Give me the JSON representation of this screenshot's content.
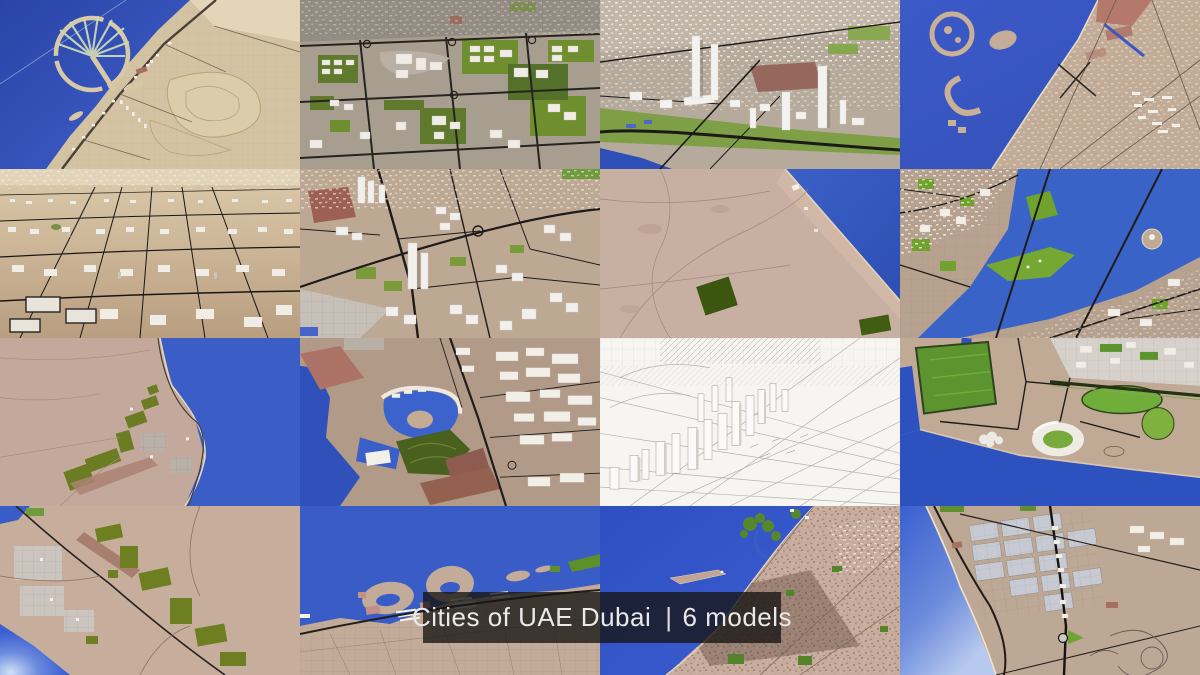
{
  "caption": {
    "title": "Cities of UAE Dubai",
    "separator": "|",
    "count_label": "6 models"
  },
  "grid": {
    "rows": 4,
    "cols": 4,
    "tile_count": 16
  },
  "colors": {
    "sea": "#3a5cc6",
    "sea_deep": "#2e4fb4",
    "sea_highlight": "#cfe0f5",
    "land_tan": "#c2a996",
    "land_desert": "#cdb697",
    "land_gray": "#a89e90",
    "green_bright": "#6fa32e",
    "green_olive": "#5a7324",
    "green_dark": "#3a560f",
    "road": "#1e1b18",
    "building_white": "#f1efeb",
    "red_block": "#9c6b5f",
    "wireframe_bg": "#f6f5f2",
    "caption_bg": "rgba(22,20,18,0.78)",
    "caption_text": "#e9e9e9"
  },
  "tiles": [
    {
      "id": "palm-jumeirah-aerial",
      "scene": "Palm Jumeirah island and coastline, aerial satellite style"
    },
    {
      "id": "planned-campus-render",
      "scene": "Master-planned district, lawns and white buildings"
    },
    {
      "id": "marina-towers-render",
      "scene": "3D city with tall white towers and green belts"
    },
    {
      "id": "deira-coast-topdown",
      "scene": "Top-down coastline with artificial islands and port"
    },
    {
      "id": "desert-lowrise-perspective",
      "scene": "Dense white low-rise blocks over desert, perspective"
    },
    {
      "id": "downtown-roads-render",
      "scene": "3D downtown, main road, towers and plots"
    },
    {
      "id": "flat-coast-map",
      "scene": "Flat terrain with shoreline and dark farm plot"
    },
    {
      "id": "creek-waterway-map",
      "scene": "Creek waterway with parks, island and bridges"
    },
    {
      "id": "shoreline-plots-map",
      "scene": "Flat shoreline map with olive plots and settlements"
    },
    {
      "id": "lagoon-resort-render",
      "scene": "Lagoon resort, golf course and warehouse district"
    },
    {
      "id": "wireframe-clay-render",
      "scene": "White wireframe clay render of city skyline"
    },
    {
      "id": "sports-city-render",
      "scene": "Stadium, sports fields and waterfront"
    },
    {
      "id": "suburb-fields-map",
      "scene": "Suburb grids, farm fields, shiny sea corner"
    },
    {
      "id": "waterfront-islands-map",
      "scene": "Scalloped artificial beachfront islands"
    },
    {
      "id": "satellite-coast-map",
      "scene": "Satellite-textured coast with green inlet"
    },
    {
      "id": "grid-city-map",
      "scene": "Gridded city blocks along a shiny sea"
    }
  ]
}
